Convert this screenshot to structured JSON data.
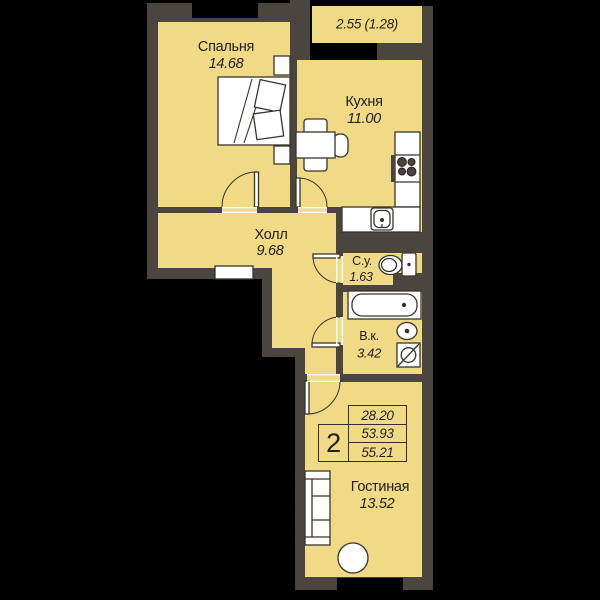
{
  "title": "2-room apartment floor plan",
  "rooms": {
    "balcony": {
      "area": "2.55 (1.28)"
    },
    "bedroom": {
      "name": "Спальня",
      "area": "14.68"
    },
    "kitchen": {
      "name": "Кухня",
      "area": "11.00"
    },
    "hall": {
      "name": "Холл",
      "area": "9.68"
    },
    "wc": {
      "name": "С.у.",
      "area": "1.63"
    },
    "bathroom": {
      "name": "В.к.",
      "area": "3.42"
    },
    "living": {
      "name": "Гостиная",
      "area": "13.52"
    }
  },
  "stamp": {
    "rooms_count": "2",
    "values": [
      "28.20",
      "53.93",
      "55.21"
    ]
  },
  "colors": {
    "background": "#000000",
    "room_fill": "#f0da86",
    "wall": "#4b453f",
    "outline": "#39332d",
    "furniture": "#ffffff"
  }
}
